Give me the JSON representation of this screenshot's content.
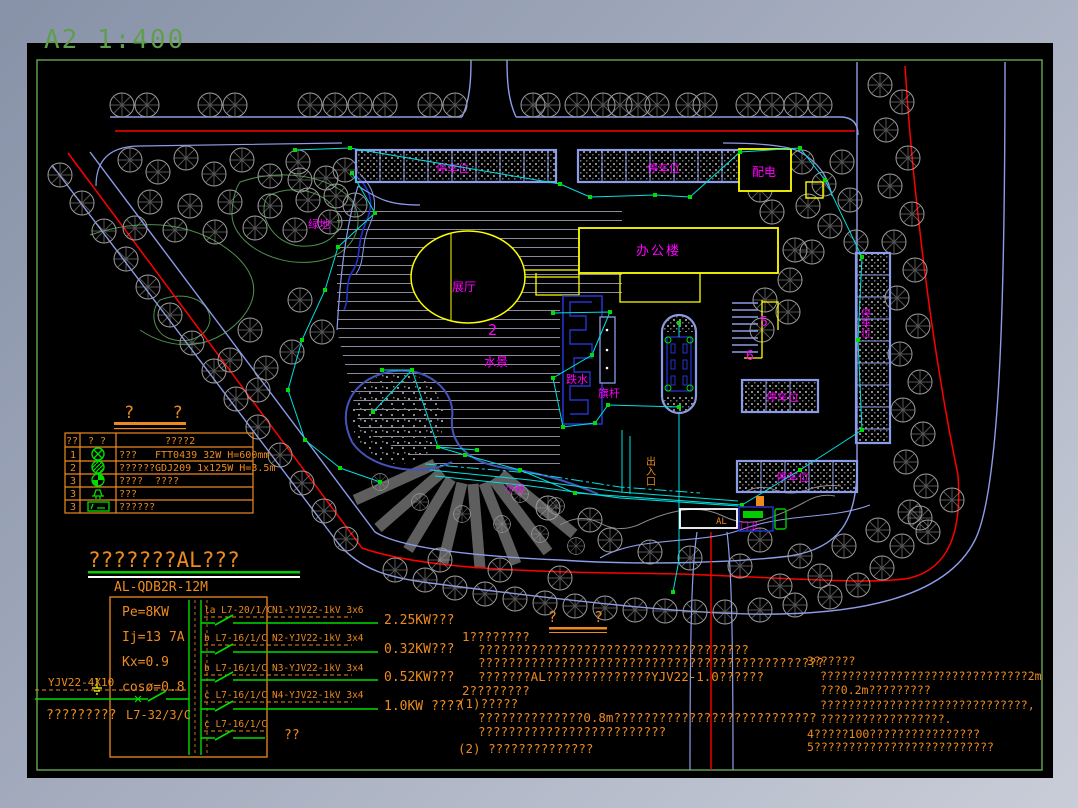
{
  "viewer": {
    "sheet_label": "A2  1:400"
  },
  "plan": {
    "labels": {
      "parking": "停车位",
      "power_room": "配电",
      "office": "办公楼",
      "exhibition": "展厅",
      "green_area": "绿地",
      "water_feature": "水景",
      "falling_water": "跌水",
      "flagpole": "旗杆",
      "path": "小径",
      "gate_house": "门卫",
      "gate_panel": "AL",
      "entrance": "出入口",
      "num_2": "2",
      "num_5": "5",
      "num_6": "6"
    }
  },
  "legend": {
    "title": "?  ?",
    "headers": [
      "??",
      "? ?",
      "????2"
    ],
    "rows": [
      {
        "no": "1",
        "desc": "???",
        "spec": "FTT0439 32W H=600mm"
      },
      {
        "no": "2",
        "desc": "??????",
        "spec": "GDJ209 1x125W H=3.5m"
      },
      {
        "no": "3",
        "desc": "????",
        "spec": "????"
      },
      {
        "no": "3",
        "desc": "???",
        "spec": ""
      },
      {
        "no": "3",
        "desc": "??????",
        "spec": ""
      }
    ]
  },
  "schematic": {
    "title": "???????AL???",
    "panel_model": "AL-QDB2R-12M",
    "params": [
      "Pe=8KW",
      "Ij=13 7A",
      "Kx=0.9",
      "cosø=0.8"
    ],
    "incoming": {
      "cable": "YJV22-4X10",
      "label": "?????????",
      "breaker": "L7-32/3/C"
    },
    "circuits": [
      {
        "breaker": "la L7-20/1/C",
        "cable": "N1-YJV22-1kV 3x6",
        "load": "2.25KW???"
      },
      {
        "breaker": "b L7-16/1/C",
        "cable": "N2-YJV22-1kV 3x4",
        "load": "0.32KW???"
      },
      {
        "breaker": "b L7-16/1/C",
        "cable": "N3-YJV22-1kV 3x4",
        "load": "0.52KW???"
      },
      {
        "breaker": "c L7-16/1/C",
        "cable": "N4-YJV22-1kV 3x4",
        "load": "1.0KW ????"
      },
      {
        "breaker": "c L7-16/1/C",
        "cable": "",
        "load": "??"
      }
    ]
  },
  "notes": {
    "title": "?  ?",
    "left": [
      "1????????",
      "????????????????????????????????????",
      "??????????????????????????????????????????????",
      "???????AL??????????????YJV22-1.0??????",
      "2????????",
      "(1)?????",
      "??????????????0.8m???????????????????????????",
      "?????????????????????????",
      "(2) ??????????????"
    ],
    "right": [
      "3??????",
      "??????????????????????????????2m",
      "???0.2m?????????",
      "??????????????????????????????,",
      "??????????????????.",
      "4?????100????????????????",
      "5??????????????????????????"
    ]
  },
  "colors": {
    "orange": "#ED8A1E",
    "magenta": "#FF00FF",
    "green": "#00DD00",
    "yellow": "#FFFF00",
    "road_blue": "#8D9CE8",
    "deep_blue": "#2233CC",
    "cyan": "#00E0E0",
    "red": "#FF0000",
    "tree_gray": "#9C9C9C",
    "frame_green": "#5F9E4D",
    "canvas": "#000000"
  }
}
